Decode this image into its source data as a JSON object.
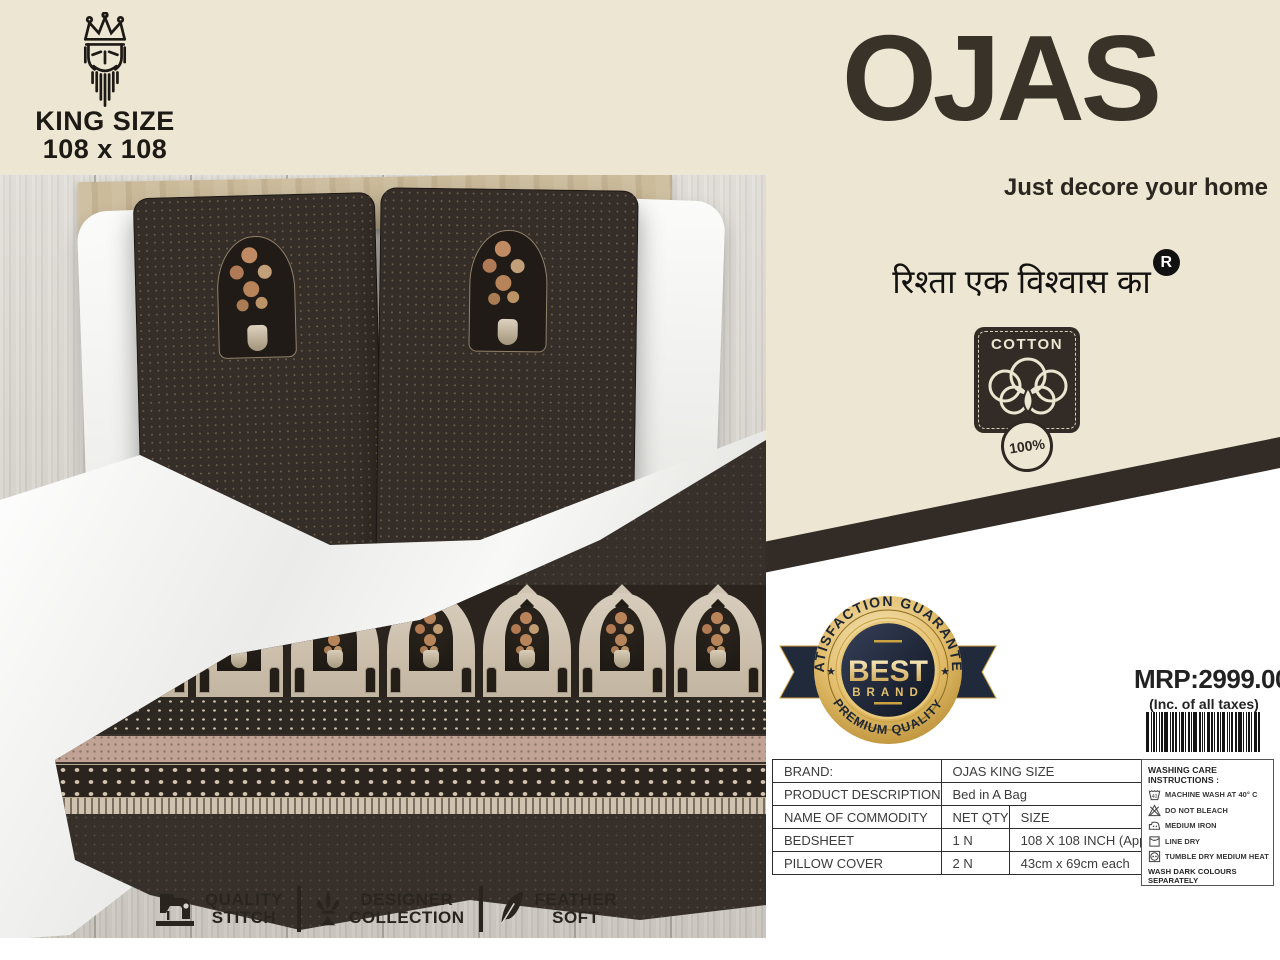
{
  "colors": {
    "cream": "#ece6d2",
    "ink": "#332c26",
    "gold": "#d1a64b",
    "navy": "#1f2837",
    "sheet_brown": "#362e27",
    "pink_band": "#c0a394"
  },
  "size_tag": {
    "logo": "king-crown-icon",
    "line1": "KING SIZE",
    "line2": "108 x 108"
  },
  "brand": {
    "name": "OJAS",
    "tagline": "Just decore your home",
    "slogan_hindi": "रिश्ता एक विश्वास का",
    "registered": "R"
  },
  "cotton_badge": {
    "label": "COTTON",
    "percent": "100%"
  },
  "best_badge": {
    "arc_top": "SATISFACTION GUARANTEE",
    "center_top": "BEST",
    "center_bottom": "BRAND",
    "arc_bottom": "PREMIUM QUALITY",
    "star_left": "★",
    "star_right": "★"
  },
  "pricing": {
    "mrp": "MRP:2999.00/-",
    "tax_note": "(Inc. of all taxes)"
  },
  "spec_table": {
    "rows": [
      {
        "label": "BRAND:",
        "value": "OJAS KING SIZE"
      },
      {
        "label": "PRODUCT DESCRIPTION",
        "value": "Bed in A Bag"
      },
      {
        "label": "NAME OF COMMODITY",
        "qty": "NET QTY",
        "size": "SIZE"
      },
      {
        "label": "BEDSHEET",
        "qty": "1 N",
        "size": "108 X 108 INCH (Approx)"
      },
      {
        "label": "PILLOW COVER",
        "qty": "2 N",
        "size": "43cm x 69cm each"
      }
    ]
  },
  "care": {
    "title": "WASHING CARE INSTRUCTIONS :",
    "items": [
      {
        "icon": "machine-wash-icon",
        "label": "MACHINE WASH AT 40° C"
      },
      {
        "icon": "do-not-bleach-icon",
        "label": "DO NOT BLEACH"
      },
      {
        "icon": "medium-iron-icon",
        "label": "MEDIUM IRON"
      },
      {
        "icon": "line-dry-icon",
        "label": "LINE DRY"
      },
      {
        "icon": "tumble-dry-icon",
        "label": "TUMBLE DRY MEDIUM HEAT"
      }
    ],
    "footnote": "WASH DARK COLOURS SEPARATELY"
  },
  "features": [
    {
      "icon": "sewing-machine-icon",
      "line1": "QUALITY",
      "line2": "STITCH"
    },
    {
      "icon": "fleur-de-lis-icon",
      "line1": "DESIGNER",
      "line2": "COLLECTION"
    },
    {
      "icon": "feather-icon",
      "line1": "FEATHER",
      "line2": "SOFT"
    }
  ]
}
